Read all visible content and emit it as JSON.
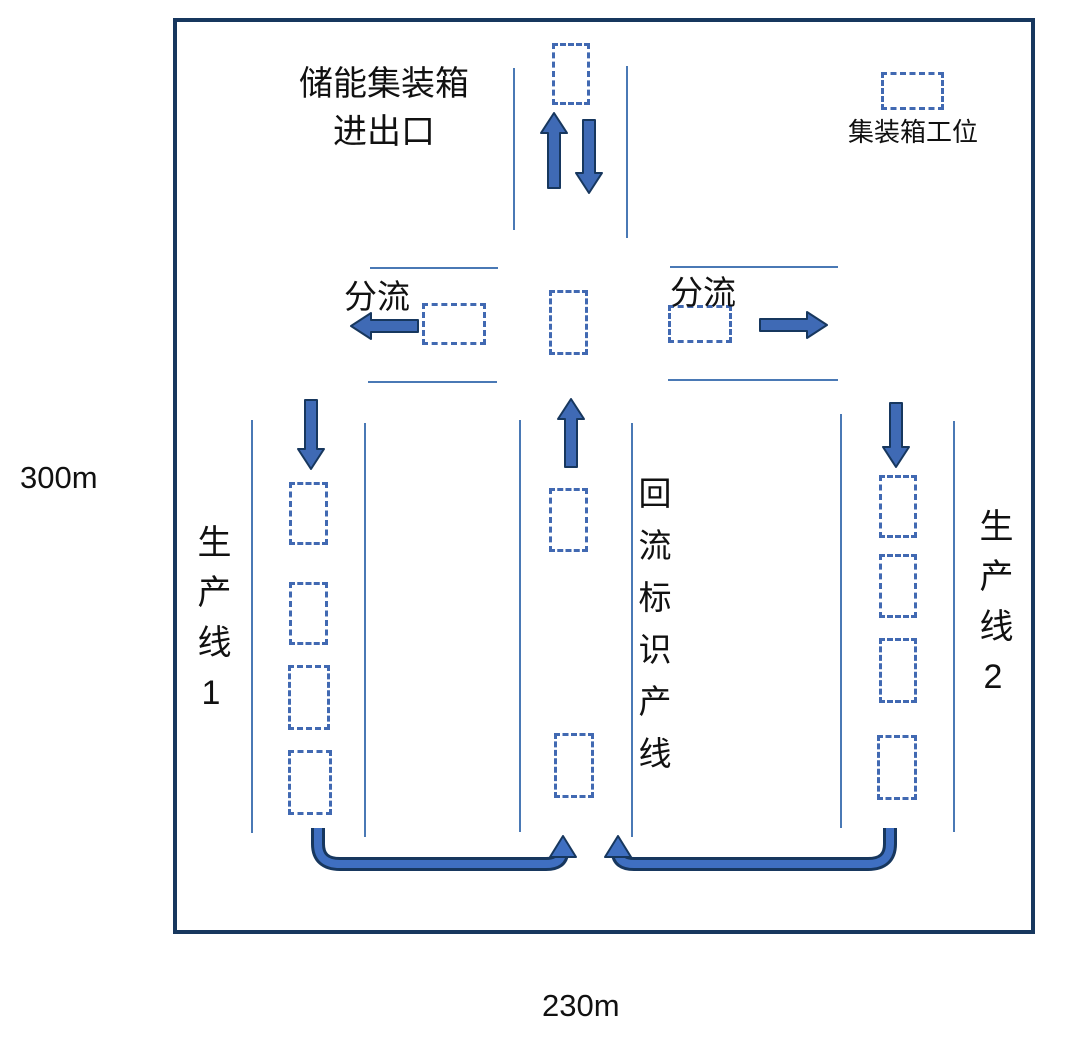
{
  "diagram": {
    "entrance_label_line1": "储能集装箱",
    "entrance_label_line2": "进出口",
    "legend_label": "集装箱工位",
    "split_left_label": "分流",
    "split_right_label": "分流",
    "production_line_1_label": "生产线1",
    "return_line_label": "回流标识产线",
    "production_line_2_label": "生产线2",
    "height_label": "300m",
    "width_label": "230m"
  },
  "colors": {
    "boundary": "#17375e",
    "lane_line": "#4a79b5",
    "slot_border": "#4169b2",
    "arrow_fill": "#3f6ab5",
    "arrow_outline": "#17375e",
    "curve_fill": "#3f6fc1",
    "text": "#111111"
  }
}
